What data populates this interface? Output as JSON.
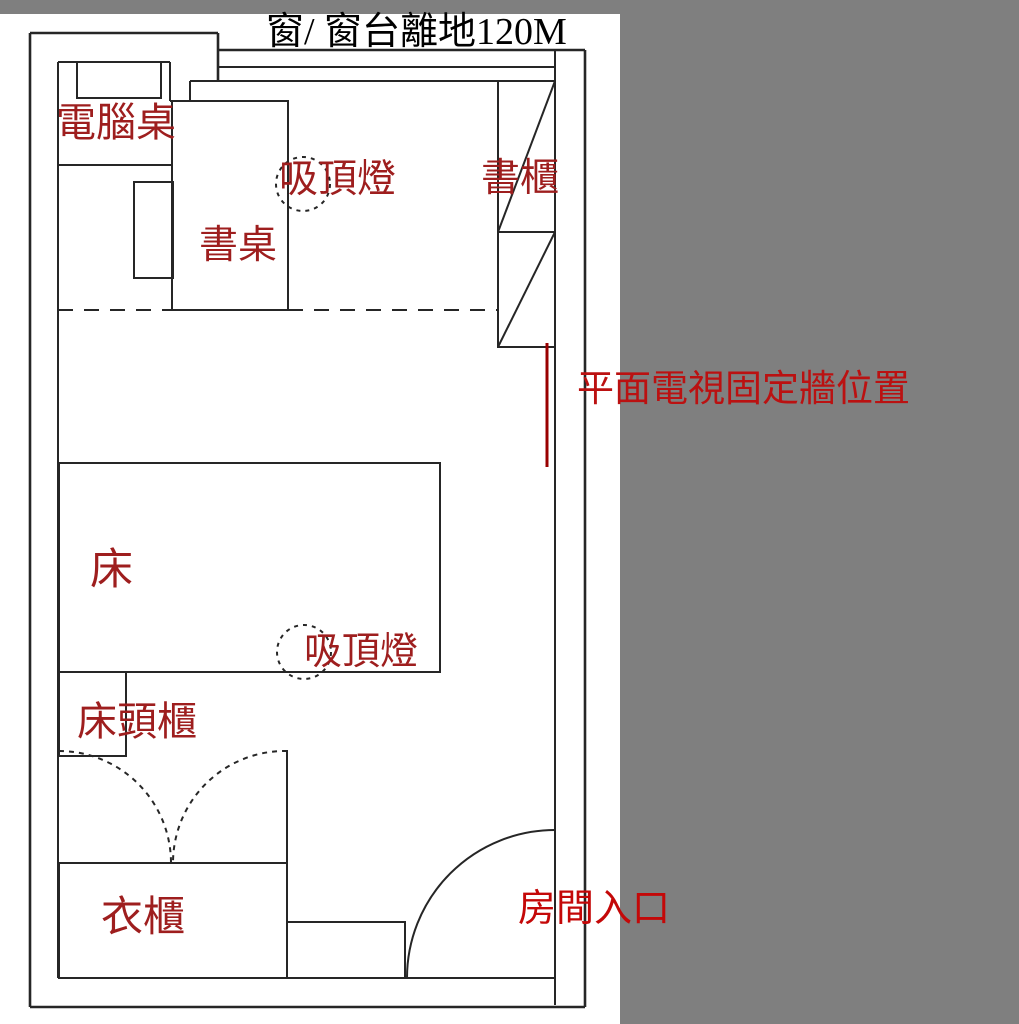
{
  "title": "窗/ 窗台離地120M",
  "colors": {
    "outside": "#7F7F7F",
    "wall_line": "#262626",
    "furniture_label": "#9E1E1E",
    "tv_label": "#BB1111",
    "entrance_label": "#C40808",
    "tv_line": "#990000"
  },
  "labels": {
    "computer_desk": "電腦桌",
    "ceiling_lamp_top": "吸頂燈",
    "bookcase": "書櫃",
    "desk": "書桌",
    "tv_wall": "平面電視固定牆位置",
    "bed": "床",
    "ceiling_lamp_bottom": "吸頂燈",
    "bedside_table": "床頭櫃",
    "wardrobe": "衣櫃",
    "entrance": "房間入口"
  }
}
